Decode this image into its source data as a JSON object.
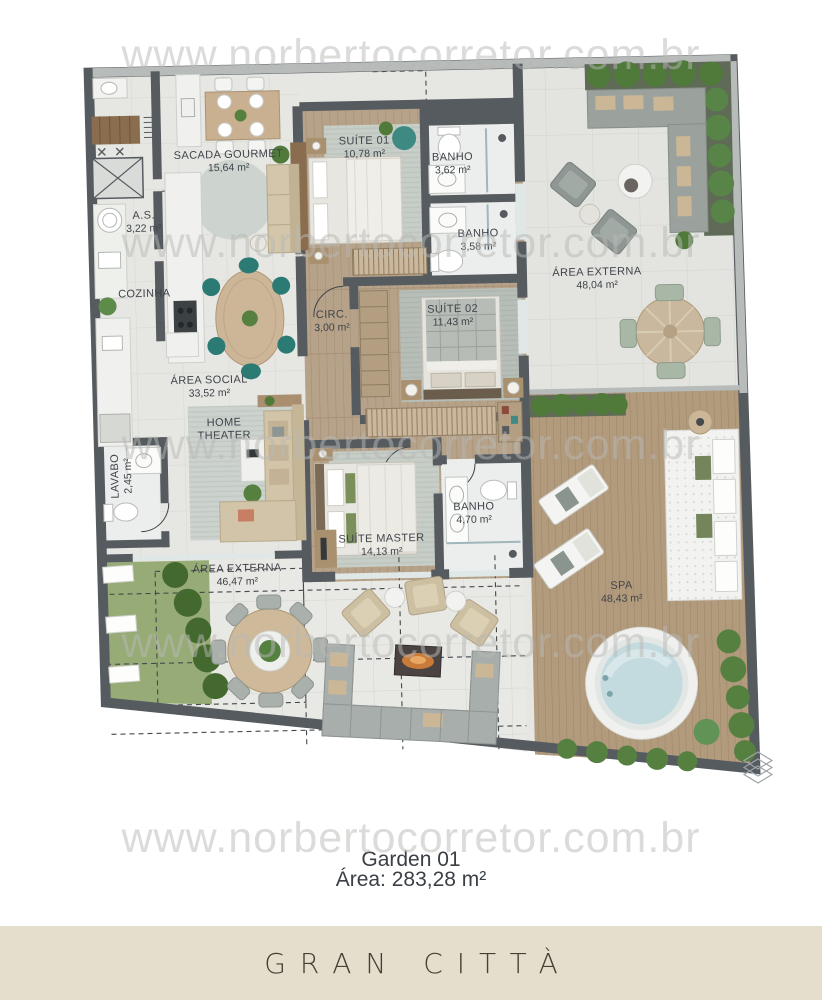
{
  "watermark": {
    "text": "www.norbertocorretor.com.br"
  },
  "plan": {
    "rooms": [
      {
        "id": "sacada-gourmet",
        "name": "SACADA GOURMET",
        "area": "15,64 m²"
      },
      {
        "id": "as",
        "name": "A.S.",
        "area": "3,22 m²"
      },
      {
        "id": "cozinha",
        "name": "COZINHA",
        "area": ""
      },
      {
        "id": "suite-01",
        "name": "SUÍTE 01",
        "area": "10,78 m²"
      },
      {
        "id": "banho-1",
        "name": "BANHO",
        "area": "3,62 m²"
      },
      {
        "id": "banho-2",
        "name": "BANHO",
        "area": "3,58 m²"
      },
      {
        "id": "circ",
        "name": "CIRC.",
        "area": "3,00 m²"
      },
      {
        "id": "suite-02",
        "name": "SUÍTE 02",
        "area": "11,43 m²"
      },
      {
        "id": "area-externa-direita",
        "name": "ÁREA EXTERNA",
        "area": "48,04 m²"
      },
      {
        "id": "area-social",
        "name": "ÁREA SOCIAL",
        "area": "33,52 m²"
      },
      {
        "id": "home-theater",
        "name": "HOME THEATER",
        "area": ""
      },
      {
        "id": "lavabo",
        "name": "LAVABO",
        "area": "2,45 m²"
      },
      {
        "id": "suite-master",
        "name": "SUÍTE MASTER",
        "area": "14,13 m²"
      },
      {
        "id": "banho-master",
        "name": "BANHO",
        "area": "4,70 m²"
      },
      {
        "id": "area-externa-esquerda",
        "name": "ÁREA EXTERNA",
        "area": "46,47 m²"
      },
      {
        "id": "spa",
        "name": "SPA",
        "area": "48,43 m²"
      }
    ]
  },
  "footer": {
    "unit": "Garden 01",
    "area": "Área: 283,28 m²"
  },
  "banner": {
    "title": "GRAN CITTÀ"
  },
  "logo": {
    "icon": "stacked-diamonds"
  },
  "colors": {
    "banner_bg": "#e5decd",
    "wall": "#565b60",
    "deck_wood": "#b29a7d",
    "greenery": "#55803f",
    "watermark_gray": "#b9b9b6"
  }
}
